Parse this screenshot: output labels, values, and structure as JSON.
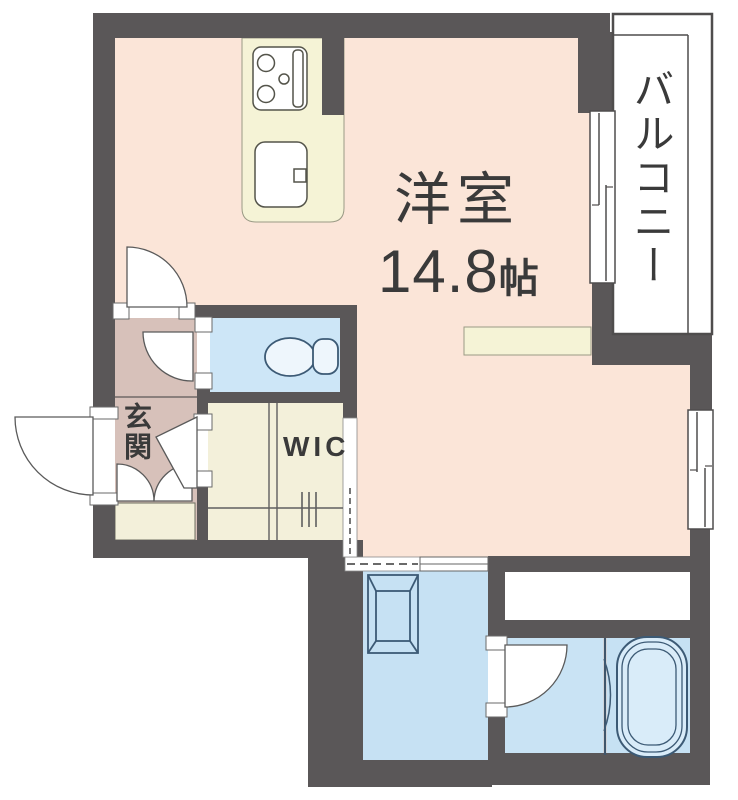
{
  "plan": {
    "type": "apartment-floor-plan",
    "rooms": {
      "main_room": {
        "label": "洋室",
        "size_value": "14.8",
        "size_unit": "帖",
        "color": "#fbe5d8"
      },
      "balcony": {
        "label": "バルコニー",
        "color": "#ffffff"
      },
      "entrance": {
        "label": "玄関",
        "color": "#d7c1ba"
      },
      "wic": {
        "label": "WIC",
        "color": "#f3f0da"
      },
      "kitchen": {
        "color": "#f5f3d6"
      },
      "toilet": {
        "color": "#cde6f7"
      },
      "washroom": {
        "color": "#c6e1f3"
      },
      "dressing_room": {
        "color": "#c9e3f4"
      },
      "bathroom": {
        "color": "#c6e1f3"
      }
    },
    "fixtures": [
      "gas-stove",
      "kitchen-sink",
      "toilet",
      "washing-machine-pan",
      "bathtub",
      "clothes-rod",
      "counter"
    ],
    "colors": {
      "wall": "#5a5758",
      "outline": "#4f4d4d",
      "fixture_blue": "#3c5a75",
      "kitchen_line": "#6b6b5a",
      "text": "#3a3a3a",
      "background": "#ffffff"
    }
  }
}
